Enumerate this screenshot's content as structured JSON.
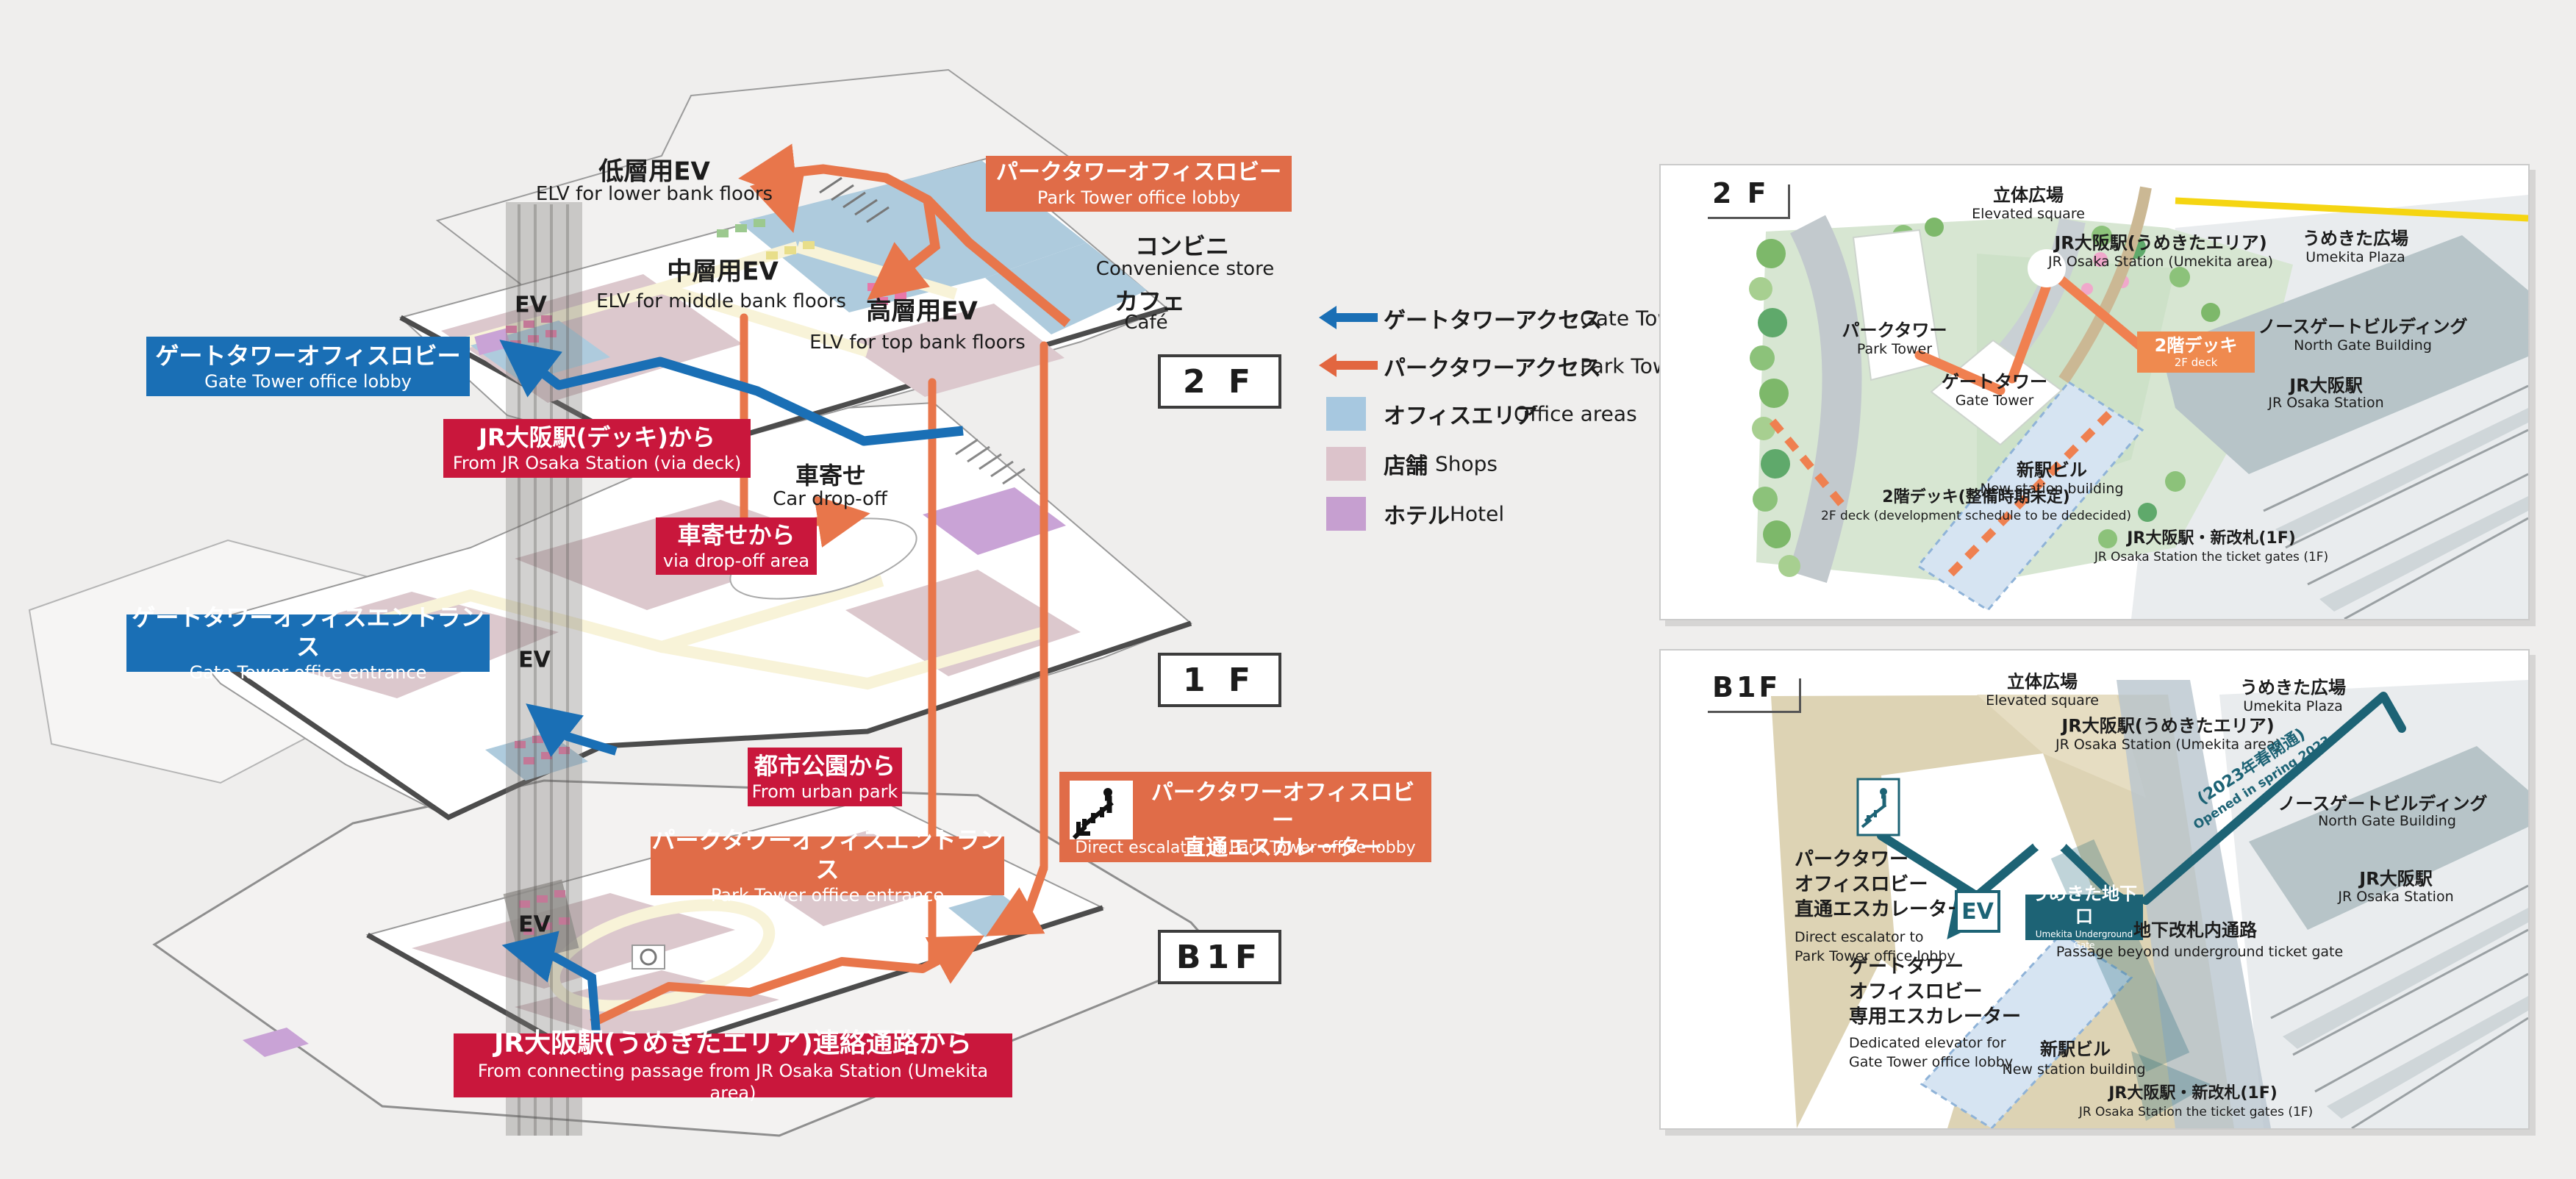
{
  "iso": {
    "floor_tags": {
      "f2": "2 F",
      "f1": "1 F",
      "b1f": "B1F"
    },
    "ev": "EV",
    "labels": {
      "elv_lower_jp": "低層用EV",
      "elv_lower_en": "ELV for lower bank floors",
      "elv_middle_jp": "中層用EV",
      "elv_middle_en": "ELV for middle bank floors",
      "elv_top_jp": "高層用EV",
      "elv_top_en": "ELV for top bank floors",
      "convenience_jp": "コンビニ",
      "convenience_en": "Convenience store",
      "cafe_jp": "カフェ",
      "cafe_en": "Café",
      "drop_off_jp": "車寄せ",
      "drop_off_en": "Car drop-off"
    },
    "callouts": {
      "park_lobby": {
        "jp": "パークタワーオフィスロビー",
        "en": "Park Tower office lobby"
      },
      "gate_lobby": {
        "jp": "ゲートタワーオフィスロビー",
        "en": "Gate Tower office lobby"
      },
      "from_deck": {
        "jp": "JR大阪駅(デッキ)から",
        "en": "From JR Osaka Station (via deck)"
      },
      "via_drop": {
        "jp": "車寄せから",
        "en": "via drop-off area"
      },
      "gate_entrance": {
        "jp": "ゲートタワーオフィスエントランス",
        "en": "Gate Tower office entrance"
      },
      "from_park": {
        "jp": "都市公園から",
        "en": "From urban park"
      },
      "direct_escalator": {
        "jp1": "パークタワーオフィスロビー",
        "jp2": "直通エスカレーター",
        "en": "Direct escalator to Park Tower office lobby"
      },
      "park_entrance": {
        "jp": "パークタワーオフィスエントランス",
        "en": "Park Tower office entrance"
      },
      "from_umekita": {
        "jp": "JR大阪駅(うめきたエリア)連絡通路から",
        "en": "From connecting passage from JR Osaka Station (Umekita area)"
      }
    }
  },
  "legend": {
    "gate_jp": "ゲートタワーアクセス",
    "gate_en": "Gate Tower access",
    "park_jp": "パークタワーアクセス",
    "park_en": "Park Tower access",
    "office_jp": "オフィスエリア",
    "office_en": "Office areas",
    "shops_jp": "店舗",
    "shops_en": "Shops",
    "hotel_jp": "ホテル",
    "hotel_en": "Hotel",
    "colors": {
      "gate_access": "#1a6fb5",
      "park_access": "#e26640",
      "office": "#a7c8e0",
      "shops": "#dcc3cb",
      "hotel": "#c69fd0"
    }
  },
  "panel_2f": {
    "tag": "2 F",
    "elevated_jp": "立体広場",
    "elevated_en": "Elevated square",
    "jr_umekita_jp": "JR大阪駅(うめきたエリア)",
    "jr_umekita_en": "JR Osaka Station (Umekita area)",
    "umekita_plaza_jp": "うめきた広場",
    "umekita_plaza_en": "Umekita Plaza",
    "north_gate_jp": "ノースゲートビルディング",
    "north_gate_en": "North Gate Building",
    "jr_osaka_jp": "JR大阪駅",
    "jr_osaka_en": "JR Osaka Station",
    "park_tower_jp": "パークタワー",
    "park_tower_en": "Park Tower",
    "gate_tower_jp": "ゲートタワー",
    "gate_tower_en": "Gate Tower",
    "new_station_jp": "新駅ビル",
    "new_station_en": "New station building",
    "deck_badge_jp": "2階デッキ",
    "deck_badge_en": "2F deck",
    "deck_undecided_jp": "2階デッキ(整備時期未定)",
    "deck_undecided_en": "2F deck (development schedule to be dedecided)",
    "new_gates_jp": "JR大阪駅・新改札(1F)",
    "new_gates_en": "JR Osaka Station the ticket gates (1F)"
  },
  "panel_b1f": {
    "tag": "B1F",
    "elevated_jp": "立体広場",
    "elevated_en": "Elevated square",
    "jr_umekita_jp": "JR大阪駅(うめきたエリア)",
    "jr_umekita_en": "JR Osaka Station (Umekita area)",
    "umekita_plaza_jp": "うめきた広場",
    "umekita_plaza_en": "Umekita Plaza",
    "north_gate_jp": "ノースゲートビルディング",
    "north_gate_en": "North Gate Building",
    "jr_osaka_jp": "JR大阪駅",
    "jr_osaka_en": "JR Osaka Station",
    "direct_esc_jp1": "パークタワー",
    "direct_esc_jp2": "オフィスロビー",
    "direct_esc_jp3": "直通エスカレーター",
    "direct_esc_en1": "Direct escalator to",
    "direct_esc_en2": "Park Tower office lobby",
    "gate_badge_jp": "うめきた地下口",
    "gate_badge_en": "Umekita Underground Gate",
    "opened_jp": "(2023年春開通)",
    "opened_en": "Opened in spring 2023",
    "ev": "EV",
    "gate_esc_jp1": "ゲートタワー",
    "gate_esc_jp2": "オフィスロビー",
    "gate_esc_jp3": "専用エスカレーター",
    "gate_esc_en1": "Dedicated elevator for",
    "gate_esc_en2": "Gate Tower office lobby",
    "passage_jp": "地下改札内通路",
    "passage_en": "Passage beyond underground ticket gate",
    "new_station_jp": "新駅ビル",
    "new_station_en": "New station building",
    "new_gates_jp": "JR大阪駅・新改札(1F)",
    "new_gates_en": "JR Osaka Station the ticket gates (1F)"
  }
}
